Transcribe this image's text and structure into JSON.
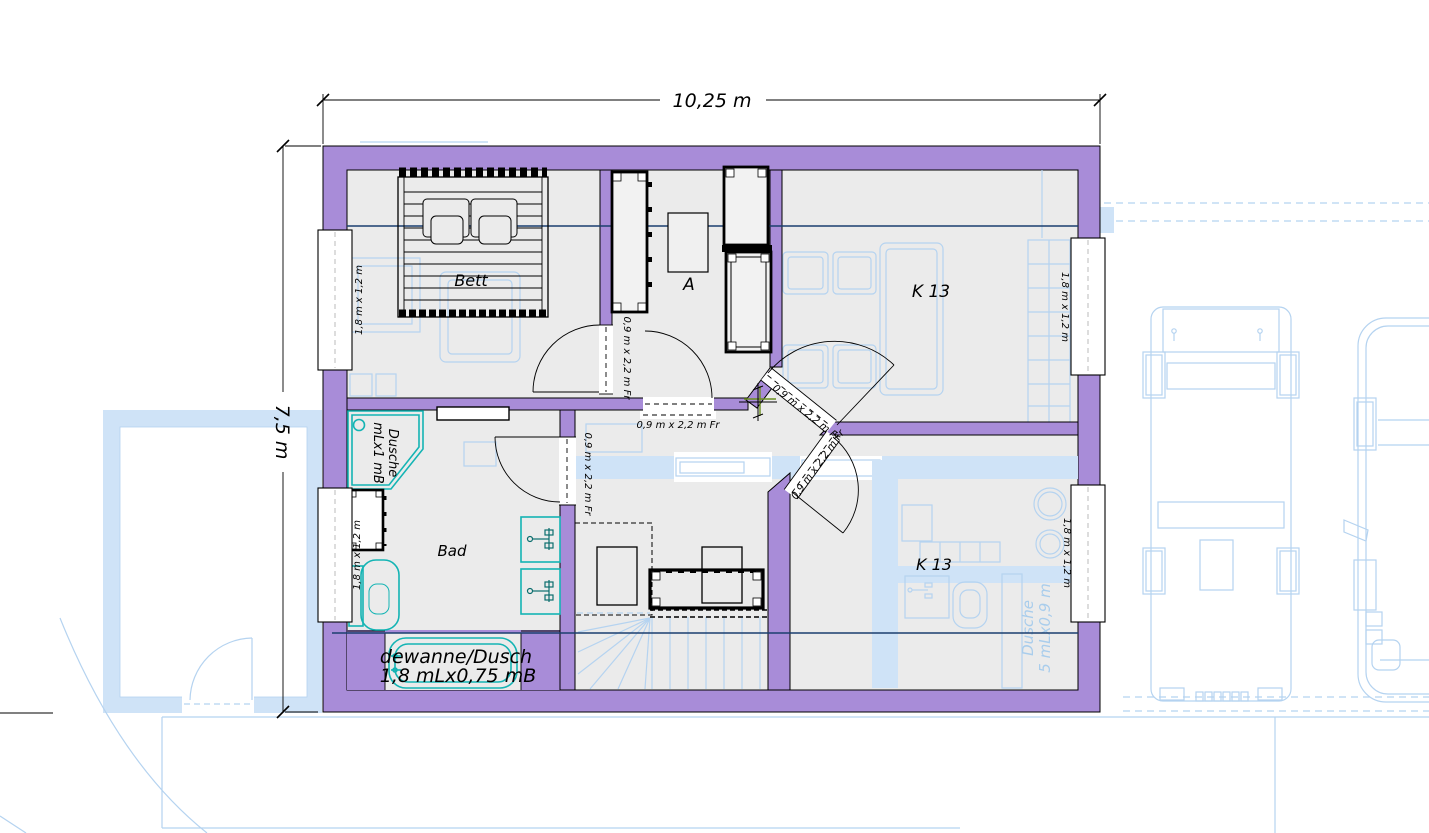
{
  "dimensions": {
    "top": "10,25 m",
    "left": "7,5 m"
  },
  "rooms": {
    "bett": "Bett",
    "hall": "A",
    "k13_top": "K 13",
    "k13_bottom": "K 13",
    "bad": "Bad"
  },
  "doors": {
    "bett": "0,9 m x 2,2 m Fr",
    "hall": "0,9 m x 2,2 m Fr",
    "bad": "0,9 m x 2,2 m Fr",
    "k13_top": "0,9 m x 2,2 m Fr",
    "k13_bottom": "0,9 m x 2,2 m Fr"
  },
  "windows": {
    "left_top": "1,8 m x 1,2 m",
    "left_bottom": "1,8 m x 1,2 m",
    "right_top": "1,8 m x 1,2 m",
    "right_bottom": "1,8 m x 1,2 m"
  },
  "fixtures": {
    "shower_line1": "Dusche",
    "shower_line2": "mLx1 mB",
    "bathtub_line1": "dewanne/Dusch",
    "bathtub_line2": "1,8 mLx0,75 mB",
    "underlay_shower_line1": "Dusche",
    "underlay_shower_line2": "5 mLx0,9 m"
  },
  "colors": {
    "wall": "#a88cd8",
    "floor": "#ebebeb",
    "underlay": "#b5d3f0",
    "underlay_fill": "#cfe3f7",
    "fixture": "#14b4b4",
    "section_line": "#1b3e6f"
  }
}
